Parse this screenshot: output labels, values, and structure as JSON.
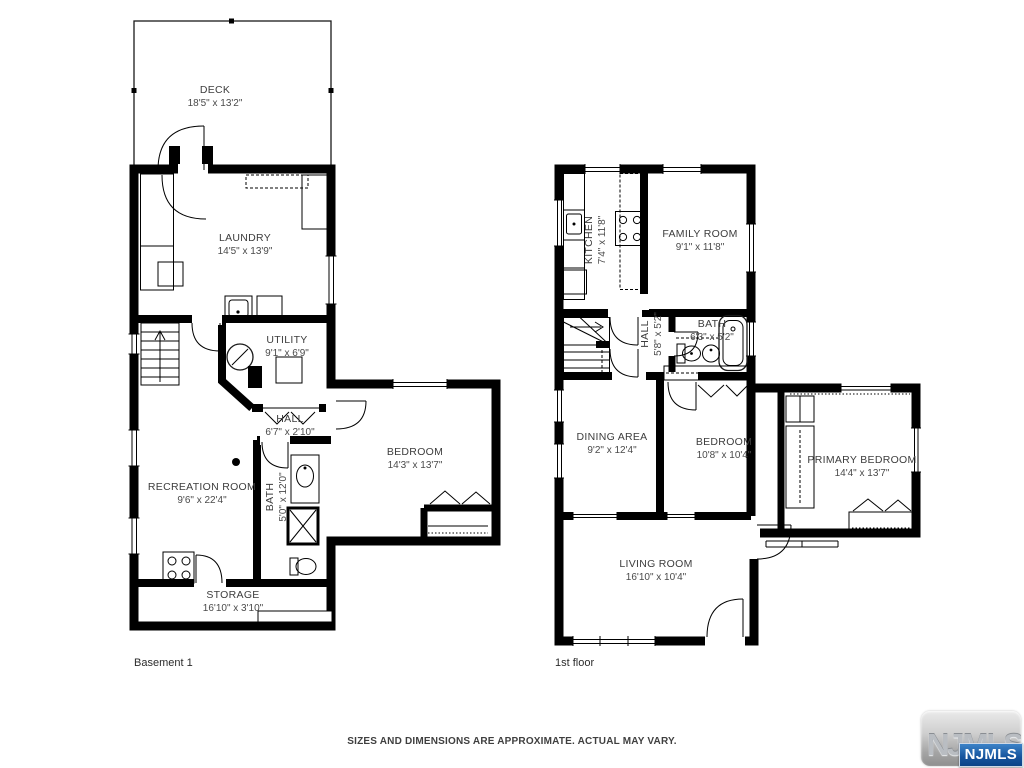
{
  "floors": [
    {
      "label": "Basement 1",
      "rooms": [
        {
          "id": "deck",
          "name": "DECK",
          "dims": "18'5\" x 13'2\""
        },
        {
          "id": "laundry",
          "name": "LAUNDRY",
          "dims": "14'5\" x 13'9\""
        },
        {
          "id": "utility",
          "name": "UTILITY",
          "dims": "9'1\" x 6'9\""
        },
        {
          "id": "hall",
          "name": "HALL",
          "dims": "6'7\" x 2'10\""
        },
        {
          "id": "bedroom",
          "name": "BEDROOM",
          "dims": "14'3\" x 13'7\""
        },
        {
          "id": "recreation-room",
          "name": "RECREATION ROOM",
          "dims": "9'6\" x 22'4\""
        },
        {
          "id": "bath",
          "name": "BATH",
          "dims": "5'0\" x 12'0\""
        },
        {
          "id": "storage",
          "name": "STORAGE",
          "dims": "16'10\" x 3'10\""
        }
      ]
    },
    {
      "label": "1st floor",
      "rooms": [
        {
          "id": "kitchen",
          "name": "KITCHEN",
          "dims": "7'4\" x 11'8\""
        },
        {
          "id": "family-room",
          "name": "FAMILY ROOM",
          "dims": "9'1\" x 11'8\""
        },
        {
          "id": "hall",
          "name": "HALL",
          "dims": "5'8\" x 5'2\""
        },
        {
          "id": "bath",
          "name": "BATH",
          "dims": "6'3\" x 5'2\""
        },
        {
          "id": "dining-area",
          "name": "DINING AREA",
          "dims": "9'2\" x 12'4\""
        },
        {
          "id": "bedroom",
          "name": "BEDROOM",
          "dims": "10'8\" x 10'4\""
        },
        {
          "id": "primary-bedroom",
          "name": "PRIMARY BEDROOM",
          "dims": "14'4\" x 13'7\""
        },
        {
          "id": "living-room",
          "name": "LIVING ROOM",
          "dims": "16'10\" x 10'4\""
        }
      ]
    }
  ],
  "footer": {
    "disclaimer": "SIZES AND DIMENSIONS ARE APPROXIMATE. ACTUAL MAY VARY."
  },
  "logo": {
    "watermark": "NJMLS",
    "badge": "NJMLS"
  },
  "colors": {
    "walls": "#000000",
    "label_text": "#3d3d3d",
    "badge_blue": "#15539c"
  }
}
